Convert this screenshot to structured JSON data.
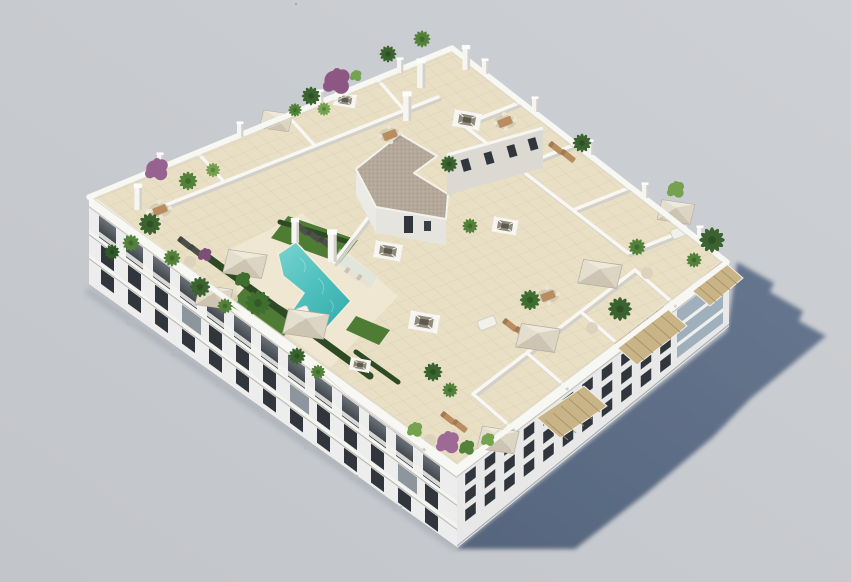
{
  "scene": {
    "type": "architectural_3d_render",
    "subject": "Aerial view of a white modern apartment building with a landscaped rooftop terrace",
    "background": "plain light grey backdrop",
    "lighting": "sun from upper left, long blue-grey shadow cast to the lower right",
    "building": {
      "floors_visible": 3,
      "facade_left": "southwest facade with recessed balconies and dark glazing",
      "facade_right": "southeast facade with grid of dark windows and corner glass balconies",
      "rooftop": {
        "pool": "L-shaped turquoise communal pool with sun deck",
        "grass_patches": 3,
        "private_terraces": "beige tiled terraces divided by low white walls",
        "stair_core": "L-shaped penthouse volume with gravel flat roof and small windows",
        "skylights": 6,
        "parasols": 8,
        "pergolas": 3,
        "planting": "palms, green shrubs and purple bougainvillea in planters"
      }
    }
  },
  "colors": {
    "bg_top": "#cdd0d4",
    "bg_bottom": "#c2c5c9",
    "shadow_near": "#52627b",
    "shadow_far": "#64758d",
    "building_white": "#f7f7f4",
    "facade_left": "#ecedec",
    "facade_right": "#e7e8e7",
    "window_dark": "#30363c",
    "balcony_glass": "#9fafbc",
    "roof_tile": "#e9dfc5",
    "deck_light": "#f0e8d3",
    "tile_line": "#c9bfa4",
    "wall_top": "#f8f7f3",
    "wall_shade": "#d3d0c8",
    "pool_light": "#79d4cf",
    "pool_mid": "#4fc0bd",
    "pool_deep": "#38adb0",
    "grass": "#4e7c35",
    "hedge": "#2e4a24",
    "gravel": "#b5a99b",
    "gravel_dot": "#a3978a",
    "pergola_wood": "#c9b488",
    "pergola_line": "#a98f62",
    "furniture_wood": "#b98d5f",
    "umbrella_light": "#efe9dc",
    "umbrella_shade": "#cdc5b2",
    "plant_dark": "#3a6330",
    "plant_mid": "#53823a",
    "plant_light": "#74a24e",
    "plant_purple": "#96628f",
    "white_furniture": "#f1f0ea",
    "rug": "#dcd2ba",
    "ac_unit": "#b6b9bd"
  }
}
